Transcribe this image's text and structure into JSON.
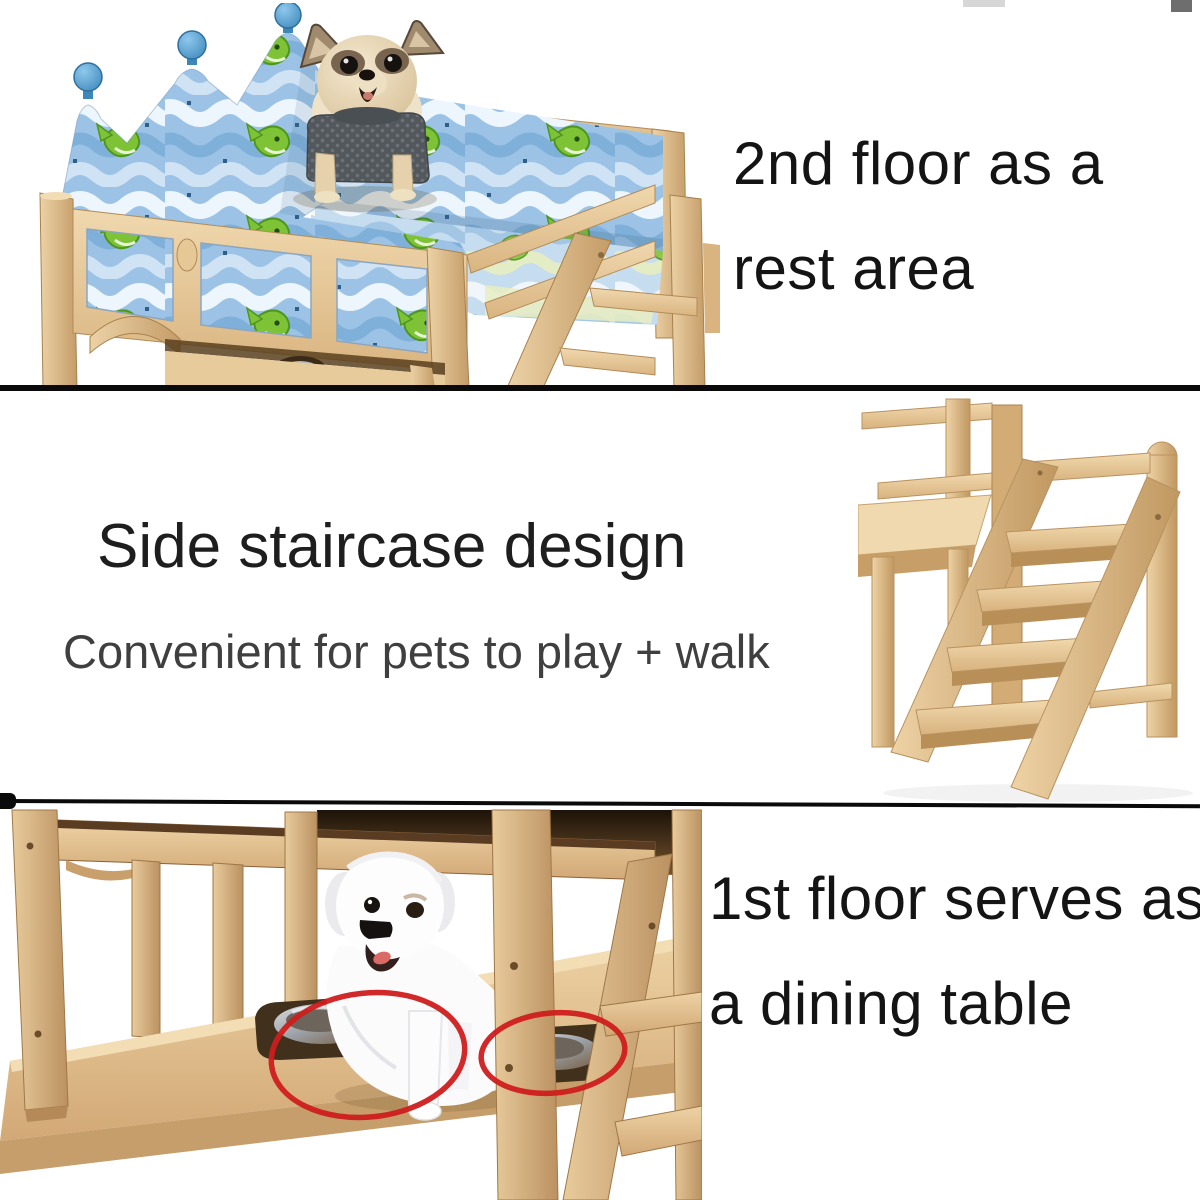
{
  "canvas": {
    "width": 1200,
    "height": 1200,
    "background": "#ffffff"
  },
  "top_section": {
    "caption_line1": "2nd floor as a",
    "caption_line2": "rest area",
    "photo_subject": "wooden pet bunk bed with crown headboard, blue wave-and-fish bumper fabric and a chihuahua wearing a gray sweater"
  },
  "middle_section": {
    "title": "Side staircase design",
    "subtitle": "Convenient for pets to play + walk",
    "photo_subject": "wooden four-step side staircase attached to the bed frame"
  },
  "bottom_section": {
    "caption_line1": "1st floor serves as",
    "caption_line2": "a dining table",
    "photo_subject": "under-bed first floor with white dog and two sunken steel food bowls circled in red"
  },
  "colors": {
    "caption_text": "#141414",
    "title_text": "#1e1e1e",
    "subtitle_text": "#3f3f3f",
    "divider": "#0a0a0a",
    "wood_light": "#f0d8ae",
    "wood_mid": "#d9b480",
    "wood_dark": "#a8814c",
    "fabric_blue": "#9cc3e6",
    "wave_white": "#eef6fd",
    "wave_blue": "#7fb0da",
    "fish_green": "#7dc335",
    "finial_blue": "#4f9fd4",
    "red_circle": "#cf1d1d",
    "steel_bowl": "#b9bdc2",
    "chihuahua_coat": "#e5d3b3",
    "sweater_gray": "#565b60",
    "white_dog_coat": "#fbfbfc"
  }
}
